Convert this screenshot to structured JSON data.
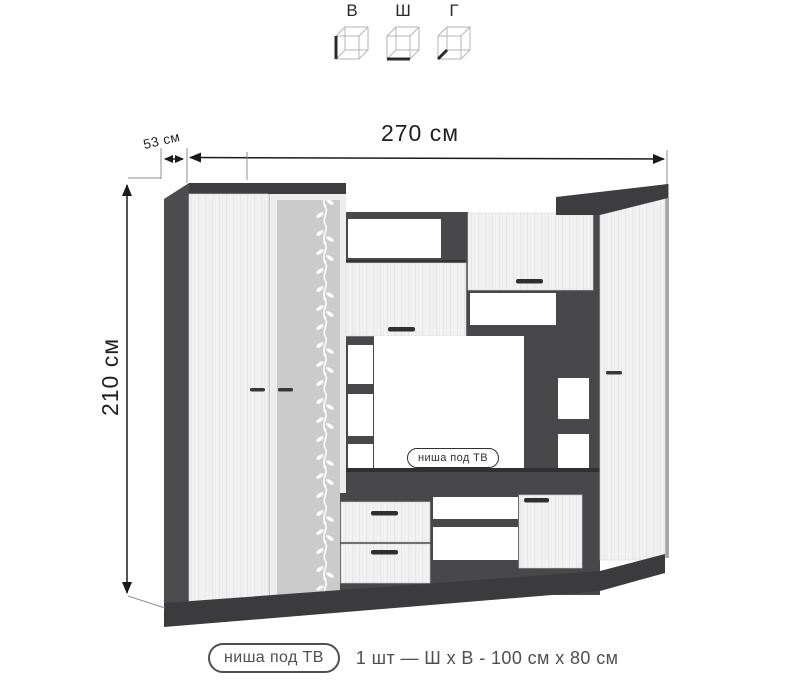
{
  "legend": {
    "items": [
      {
        "label": "В"
      },
      {
        "label": "Ш"
      },
      {
        "label": "Г"
      }
    ]
  },
  "dimensions": {
    "width_label": "270 см",
    "depth_label": "53 см",
    "height_label": "210 см"
  },
  "tv_niche_label": "ниша под ТВ",
  "caption": {
    "badge": "ниша под ТВ",
    "text": "1 шт — Ш х В - 100 см х 80 см"
  },
  "colors": {
    "dark_panel": "#4c4c4e",
    "dark_top": "#3d3d3f",
    "light_door": "#f2f2f2",
    "glass": "#cbcbcb",
    "dimension_line": "#1a1a1a"
  }
}
